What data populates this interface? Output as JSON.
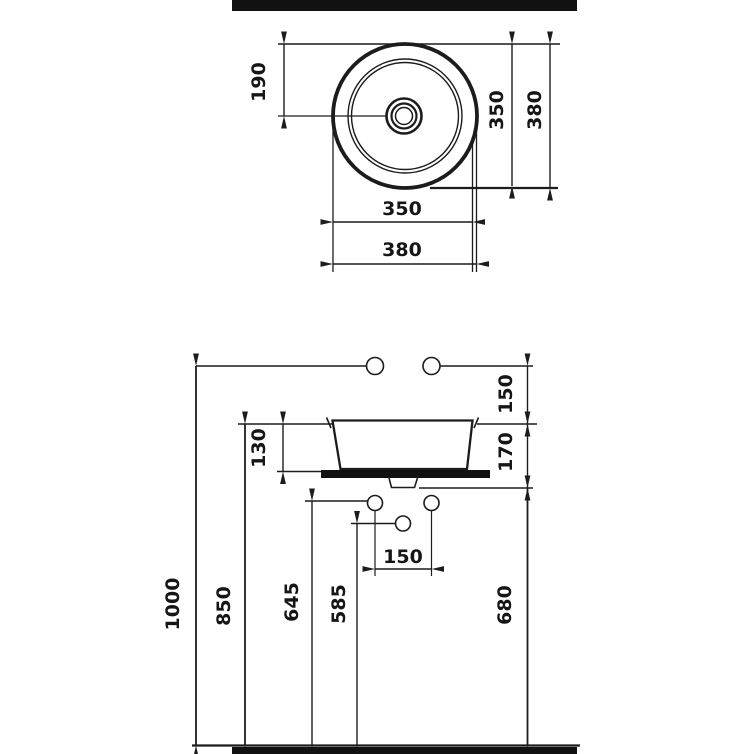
{
  "colors": {
    "line": "#1c1c1c",
    "bar_fill": "#111111",
    "background": "#ffffff",
    "text": "#161616"
  },
  "top_view": {
    "center_offset": "190",
    "inner_diameter_vertical": "350",
    "outer_diameter_vertical": "380",
    "inner_diameter_horizontal": "350",
    "outer_diameter_horizontal": "380"
  },
  "front_view": {
    "tap_to_rim": "150",
    "rim_to_counter_underside": "170",
    "basin_height": "130",
    "tap_height": "1000",
    "rim_height": "850",
    "supply_height": "645",
    "drain_height": "585",
    "underside_height": "680",
    "supply_spacing": "150"
  }
}
